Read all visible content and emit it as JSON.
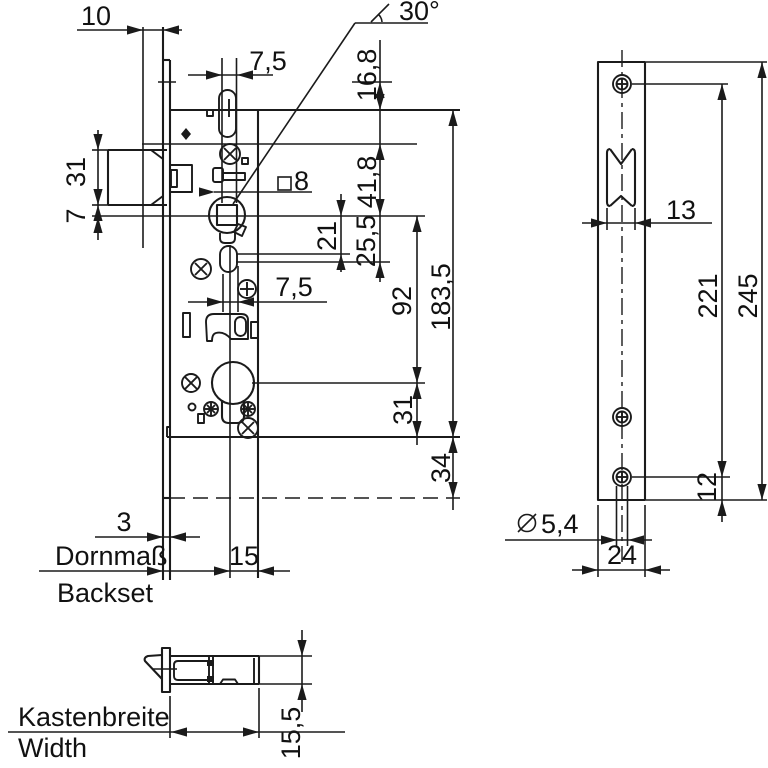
{
  "drawing": {
    "type": "technical-dimension-drawing",
    "subject": "mortise-lock",
    "colors": {
      "line": "#1b1b1b",
      "background": "#ffffff"
    }
  },
  "labels": {
    "d10": "10",
    "d75_top": "7,5",
    "d30": "30°",
    "d168": "16,8",
    "d8": "8",
    "d418": "41,8",
    "d21": "21",
    "d255": "25,5",
    "d75_mid": "7,5",
    "d92": "92",
    "d1835": "183,5",
    "d31_right": "31",
    "d34": "34",
    "d31_left": "31",
    "d7": "7",
    "d3": "3",
    "dornmass": "Dornmaß",
    "backset": "Backset",
    "d15": "15",
    "kastenbreite": "Kastenbreite",
    "width": "Width",
    "d155": "15,5",
    "d13": "13",
    "d221": "221",
    "d245": "245",
    "d12": "12",
    "d54": "5,4",
    "d24": "24"
  }
}
